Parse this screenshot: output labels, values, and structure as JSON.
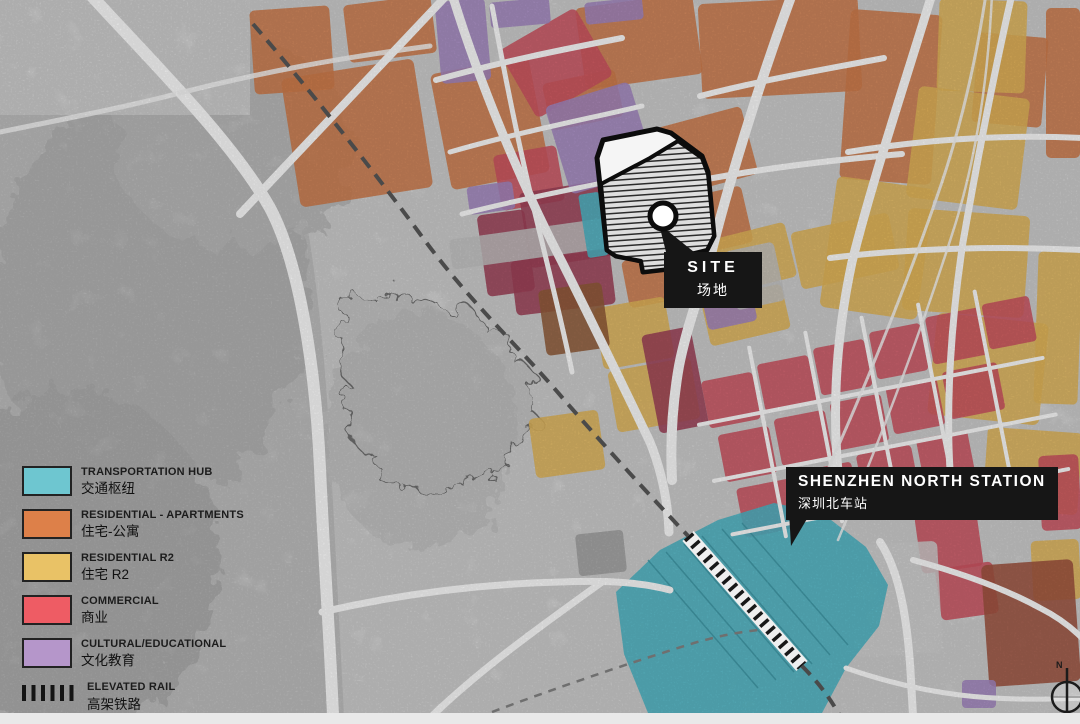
{
  "page": {
    "title": "Site Analysis Map — Shenzhen North Station"
  },
  "legend": {
    "items": [
      {
        "key": "transportation-hub",
        "label_en": "TRANSPORTATION HUB",
        "label_zh": "交通枢纽",
        "color": "#6ec6d0"
      },
      {
        "key": "residential-apartments",
        "label_en": "RESIDENTIAL - APARTMENTS",
        "label_zh": "住宅-公寓",
        "color": "#dd8049"
      },
      {
        "key": "residential-r2",
        "label_en": "RESIDENTIAL R2",
        "label_zh": "住宅  R2",
        "color": "#e9c266"
      },
      {
        "key": "commercial",
        "label_en": "COMMERCIAL",
        "label_zh": "商业",
        "color": "#ee5c64"
      },
      {
        "key": "cultural-educational",
        "label_en": "CULTURAL/EDUCATIONAL",
        "label_zh": "文化教育",
        "color": "#b596ca"
      },
      {
        "key": "elevated-rail",
        "label_en": "ELEVATED RAIL",
        "label_zh": "高架铁路",
        "color": "#141414"
      }
    ]
  },
  "callouts": {
    "site": {
      "label_en": "SITE",
      "label_zh": "场地"
    },
    "station": {
      "label_en": "SHENZHEN NORTH STATION",
      "label_zh": "深圳北车站"
    }
  },
  "compass": {
    "label": "N"
  },
  "map_colors": {
    "orange": "#cd7a4a",
    "yellow": "#dfb458",
    "red": "#cb5260",
    "dark_red": "#9c4056",
    "purple": "#a285bf",
    "teal": "#4db4c3",
    "brown": "#8f5a38",
    "maroon": "#9c513d",
    "road": "#f9f9f9",
    "terrain": "#d9d9d9",
    "label_bg": "#161616"
  }
}
